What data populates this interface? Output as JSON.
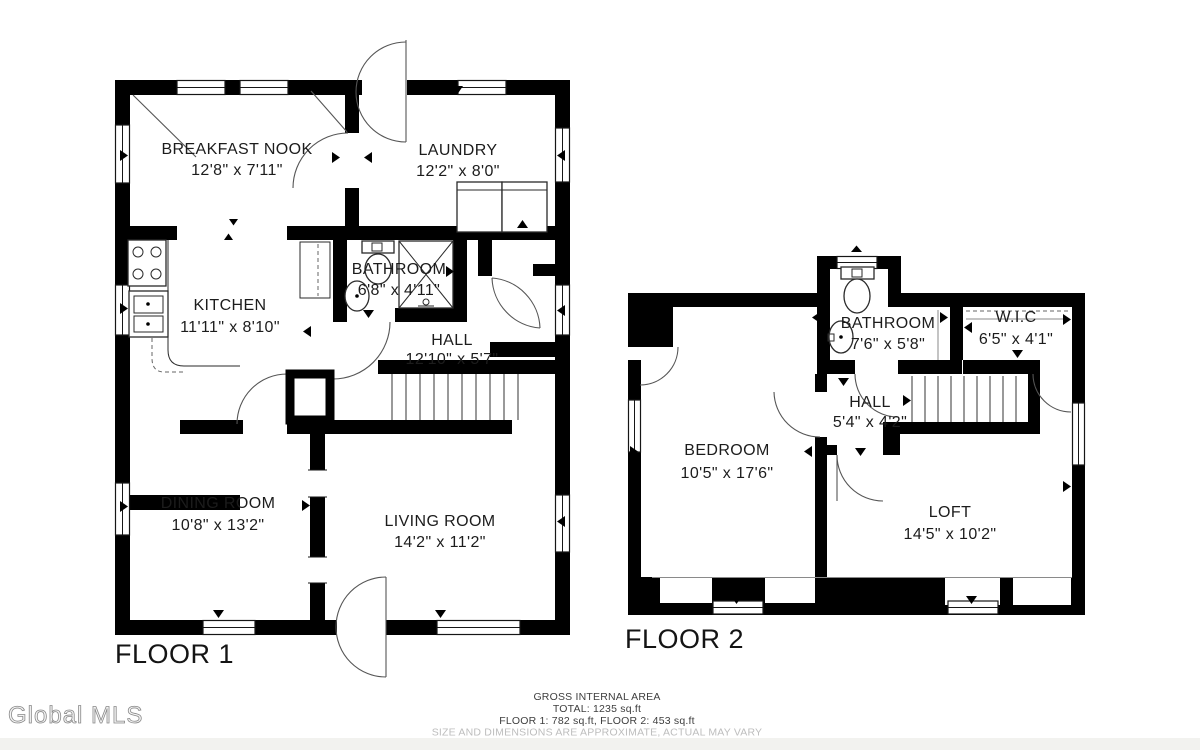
{
  "floor1": {
    "label": "FLOOR 1",
    "rooms": {
      "breakfast_nook": {
        "name": "BREAKFAST NOOK",
        "dims": "12'8\" x 7'11\""
      },
      "laundry": {
        "name": "LAUNDRY",
        "dims": "12'2\" x 8'0\""
      },
      "kitchen": {
        "name": "KITCHEN",
        "dims": "11'11\" x 8'10\""
      },
      "bathroom": {
        "name": "BATHROOM",
        "dims": "6'8\" x 4'11\""
      },
      "hall": {
        "name": "HALL",
        "dims": "12'10\" x 5'7\""
      },
      "dining_room": {
        "name": "DINING ROOM",
        "dims": "10'8\" x 13'2\""
      },
      "living_room": {
        "name": "LIVING ROOM",
        "dims": "14'2\" x 11'2\""
      }
    }
  },
  "floor2": {
    "label": "FLOOR 2",
    "rooms": {
      "bathroom": {
        "name": "BATHROOM",
        "dims": "7'6\" x 5'8\""
      },
      "wic": {
        "name": "W.I.C",
        "dims": "6'5\" x 4'1\""
      },
      "hall": {
        "name": "HALL",
        "dims": "5'4\" x 4'2\""
      },
      "bedroom": {
        "name": "BEDROOM",
        "dims": "10'5\" x 17'6\""
      },
      "loft": {
        "name": "LOFT",
        "dims": "14'5\" x 10'2\""
      }
    }
  },
  "footer": {
    "title": "GROSS INTERNAL AREA",
    "total": "TOTAL: 1235 sq.ft",
    "floors": "FLOOR 1: 782 sq.ft, FLOOR 2: 453 sq.ft",
    "disclaimer": "SIZE AND DIMENSIONS ARE APPROXIMATE, ACTUAL MAY VARY"
  },
  "watermark": "Global MLS"
}
